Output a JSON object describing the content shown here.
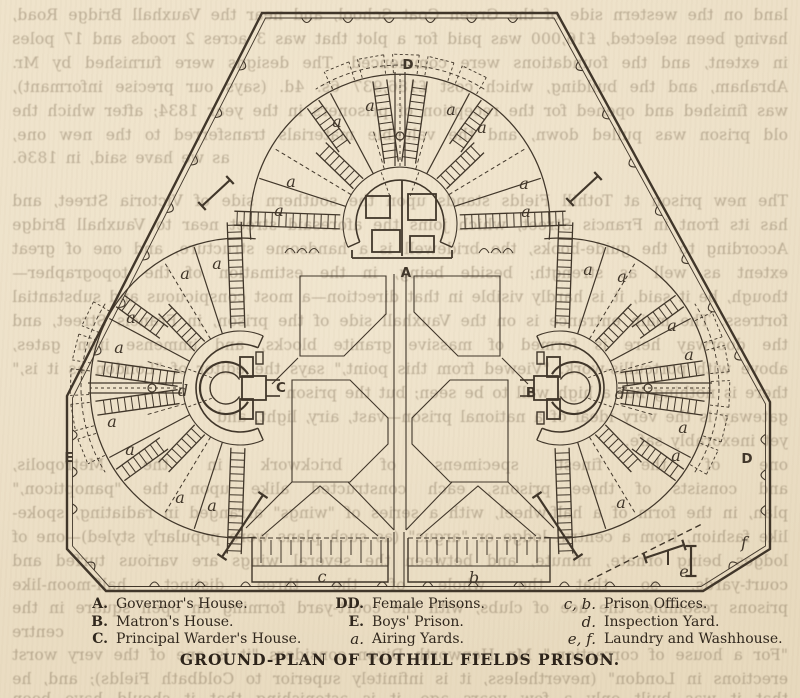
{
  "page": {
    "paper": "#ecdfc6",
    "ink": "#40362a",
    "legend_ink": "#30271d"
  },
  "title": "GROUND-PLAN OF TOTHILL FIELDS PRISON.",
  "legend": {
    "columns": [
      {
        "items": [
          {
            "key": "A.",
            "label": "Governor's House.",
            "italic_key": false
          },
          {
            "key": "B.",
            "label": "Matron's House.",
            "italic_key": false
          },
          {
            "key": "C.",
            "label": "Principal Warder's House.",
            "italic_key": false
          }
        ]
      },
      {
        "items": [
          {
            "key": "DD.",
            "label": "Female Prisons.",
            "italic_key": false
          },
          {
            "key": "E.",
            "label": "Boys' Prison.",
            "italic_key": false
          },
          {
            "key": "a.",
            "label": "Airing Yards.",
            "italic_key": true
          }
        ]
      },
      {
        "items": [
          {
            "key": "c, b.",
            "label": "Prison Offices.",
            "italic_key": true
          },
          {
            "key": "d.",
            "label": "Inspection Yard.",
            "italic_key": true
          },
          {
            "key": "e, f.",
            "label": "Laundry and Washhouse.",
            "italic_key": true
          }
        ]
      }
    ]
  },
  "plan": {
    "labels": [
      {
        "t": "D",
        "x": 408,
        "y": 64,
        "cap": true
      },
      {
        "t": "A",
        "x": 406,
        "y": 272,
        "cap": true
      },
      {
        "t": "C",
        "x": 281,
        "y": 387,
        "cap": true
      },
      {
        "t": "B",
        "x": 531,
        "y": 392,
        "cap": true
      },
      {
        "t": "E",
        "x": 69,
        "y": 457,
        "cap": true
      },
      {
        "t": "D",
        "x": 747,
        "y": 458,
        "cap": true
      },
      {
        "t": "d",
        "x": 183,
        "y": 391,
        "cap": false
      },
      {
        "t": "d",
        "x": 620,
        "y": 394,
        "cap": false
      },
      {
        "t": "c",
        "x": 322,
        "y": 577,
        "cap": false
      },
      {
        "t": "b",
        "x": 474,
        "y": 578,
        "cap": false
      },
      {
        "t": "e",
        "x": 684,
        "y": 572,
        "cap": false
      },
      {
        "t": "f",
        "x": 744,
        "y": 543,
        "cap": false
      },
      {
        "t": "a",
        "x": 337,
        "y": 122,
        "cap": false
      },
      {
        "t": "a",
        "x": 370,
        "y": 106,
        "cap": false
      },
      {
        "t": "a",
        "x": 451,
        "y": 110,
        "cap": false
      },
      {
        "t": "a",
        "x": 482,
        "y": 128,
        "cap": false
      },
      {
        "t": "a",
        "x": 291,
        "y": 182,
        "cap": false
      },
      {
        "t": "a",
        "x": 279,
        "y": 211,
        "cap": false
      },
      {
        "t": "a",
        "x": 524,
        "y": 184,
        "cap": false
      },
      {
        "t": "a",
        "x": 526,
        "y": 212,
        "cap": false
      },
      {
        "t": "a",
        "x": 217,
        "y": 264,
        "cap": false
      },
      {
        "t": "a",
        "x": 185,
        "y": 274,
        "cap": false
      },
      {
        "t": "a",
        "x": 131,
        "y": 318,
        "cap": false
      },
      {
        "t": "a",
        "x": 119,
        "y": 348,
        "cap": false
      },
      {
        "t": "a",
        "x": 112,
        "y": 422,
        "cap": false
      },
      {
        "t": "a",
        "x": 130,
        "y": 450,
        "cap": false
      },
      {
        "t": "a",
        "x": 180,
        "y": 498,
        "cap": false
      },
      {
        "t": "a",
        "x": 212,
        "y": 506,
        "cap": false
      },
      {
        "t": "a",
        "x": 588,
        "y": 270,
        "cap": false
      },
      {
        "t": "a",
        "x": 622,
        "y": 277,
        "cap": false
      },
      {
        "t": "a",
        "x": 672,
        "y": 326,
        "cap": false
      },
      {
        "t": "a",
        "x": 689,
        "y": 355,
        "cap": false
      },
      {
        "t": "a",
        "x": 683,
        "y": 428,
        "cap": false
      },
      {
        "t": "a",
        "x": 676,
        "y": 456,
        "cap": false
      },
      {
        "t": "a",
        "x": 621,
        "y": 503,
        "cap": false
      }
    ]
  },
  "bleedthrough": {
    "lines": [
      {
        "y": 4,
        "align": "j",
        "text": "land on the western side of the Green Coat School, and near the Vauxhall Bridge Road,"
      },
      {
        "y": 28,
        "align": "j",
        "text": "having been selected, £16,000 was paid for a plot that was 3 acres 2 roods and 17 poles"
      },
      {
        "y": 52,
        "align": "j",
        "text": "in extent, and the foundations were commenced.  The designs were furnished by Mr. Robert"
      },
      {
        "y": 76,
        "align": "j",
        "text": "Abraham, and the building, which cost £186,937 6s. 4d. (says our precise informant),"
      },
      {
        "y": 100,
        "align": "j",
        "text": "was finished and opened for the reception of prisoners in the year 1834; after which the"
      },
      {
        "y": 124,
        "align": "j",
        "text": "old prison was pulled down, and the valuable materials transferred to the new one,"
      },
      {
        "y": 147,
        "align": "r",
        "text": "as we have said, in 1836."
      },
      {
        "y": 190,
        "align": "j",
        "text": "The new prison at Tothill Fields stands upon the southern side of Victoria Street, and"
      },
      {
        "y": 214,
        "align": "j",
        "text": "has its front in Francis Street, which joins the aforesaid street near to Vauxhall Bridge Road."
      },
      {
        "y": 238,
        "align": "j",
        "text": "According to the guide-books, the bridewell is a handsome structure, and one of great"
      },
      {
        "y": 262,
        "align": "j",
        "text": "extent as well as strength; beside being, in the estimation of the topographer—"
      },
      {
        "y": 286,
        "align": "j",
        "text": "though, be it said, it is hardly visible in that direction—a most conspicuous and substantial"
      },
      {
        "y": 310,
        "align": "j",
        "text": "fortress.  The main entrance is on the Vauxhall side of the prison, in Francis Street, and"
      },
      {
        "y": 334,
        "align": "j",
        "text": "the doorway here is formed of massive granite blocks, and immense iron gates, ornamented"
      },
      {
        "y": 358,
        "align": "j",
        "text": "above with portcullis-work.  \"Viewed from this point,\" says the editor of \"London as it is,\""
      },
      {
        "y": 382,
        "align": "l",
        "text": "there is nothing but a high wall to be seen; but the prison"
      },
      {
        "y": 406,
        "align": "l",
        "text": "gateway is the very ideal of a national prison—vast, airy, light, and"
      },
      {
        "y": 430,
        "align": "l",
        "text": "yet inexorably safe."
      },
      {
        "y": 454,
        "align": "j",
        "text": "one of the finest specimens of brickwork in the Metropolis,"
      },
      {
        "y": 478,
        "align": "j",
        "text": "and consists of three prisons, each constructed alike upon the \"panopticon,\""
      },
      {
        "y": 502,
        "align": "j",
        "text": "plan, in the form of a half-wheel, with a series of \"wings\" arranged in radiating, spoke-"
      },
      {
        "y": 526,
        "align": "j",
        "text": "like fashion, from a central lodge or \"argus\" (as such plans were popularly styled)—one of such"
      },
      {
        "y": 550,
        "align": "j",
        "text": "lodges being ornate, minute, and between the several wings are various turfed and planted"
      },
      {
        "y": 574,
        "align": "j",
        "text": "court-yards, so that the whole of the three distinct, half-moon-like"
      },
      {
        "y": 597,
        "align": "j",
        "text": "prisons resembles the ace of clubs, with the court-yard forming an open square in the"
      },
      {
        "y": 621,
        "align": "r",
        "text": "centre"
      },
      {
        "y": 644,
        "align": "j",
        "text": "\"For a house of correction,\" Mr. Hepworth Dixon considers \"it is one of the very worst"
      },
      {
        "y": 668,
        "align": "j",
        "text": "erections in London\" (nevertheless, it is infinitely superior to Coldbath Fields); and, he adds,"
      },
      {
        "y": 688,
        "align": "j",
        "text": "that it was built only a few years ago, it is astonishing that it should have been"
      }
    ]
  }
}
